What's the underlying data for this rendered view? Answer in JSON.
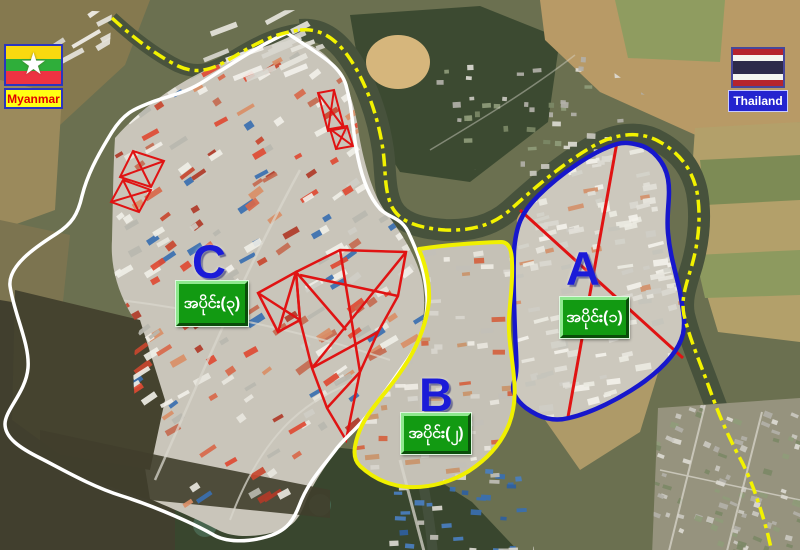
{
  "legend": {
    "left_country": "Myanmar",
    "right_country": "Thailand"
  },
  "areas": [
    {
      "id": "A",
      "letter": "A",
      "label": "အပိုင်း(၁)",
      "outline_color": "#1717cc"
    },
    {
      "id": "B",
      "letter": "B",
      "label": "အပိုင်း(၂)",
      "outline_color": "#f0f000"
    },
    {
      "id": "C",
      "letter": "C",
      "label": "အပိုင်း(၃)",
      "outline_color": "#ffffff"
    }
  ],
  "border_line": {
    "pattern": "dash-dot",
    "color": "#f2f200"
  },
  "colors": {
    "badge_green": "#129a12",
    "letter_blue": "#1b1bd8",
    "annotation_red": "#e01313",
    "river": "#49533d",
    "myanmar_flag_stripes": [
      "#f9d90f",
      "#2fae3a",
      "#ee3342"
    ],
    "thailand_flag_stripes": [
      "#b5242e",
      "#f4f5f0",
      "#2d2a4a"
    ],
    "myanmar_label_bg": "#ffff14",
    "thailand_label_bg": "#2424cf"
  }
}
